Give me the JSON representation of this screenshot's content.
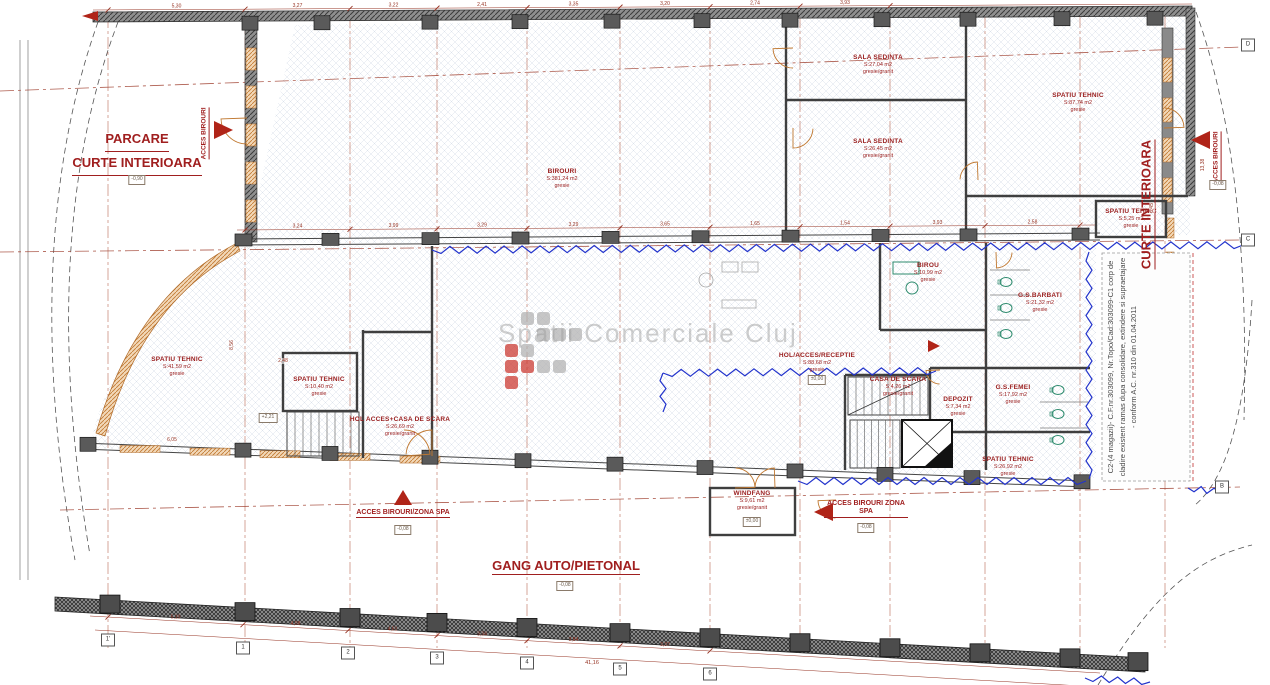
{
  "zones": {
    "parcare": {
      "line1": "PARCARE",
      "line2": "CURTE INTERIOARA"
    },
    "curte_right": "CURTE INTERIOARA",
    "gang": "GANG AUTO/PIETONAL"
  },
  "watermark": "Spatii Comerciale Cluj",
  "side_note": "C2-(4 magazii)- C.F.nr.303099, Nr.Topo/Cad:303099-C1 corp de cladire existent ramas dupa consolidare, extindere si supraetajare - conform A.C. nr.310 din 01.04.2011",
  "rooms": [
    {
      "name": "BIROURI",
      "area": "S:381,24 m2",
      "finish": "gresie"
    },
    {
      "name": "SALA SEDINTA",
      "area": "S:27,04 m2",
      "finish": "gresie/granit"
    },
    {
      "name": "SALA SEDINTA",
      "area": "S:26,45 m2",
      "finish": "gresie/granit"
    },
    {
      "name": "SPATIU TEHNIC",
      "area": "S:87,74 m2",
      "finish": "gresie"
    },
    {
      "name": "SPATIU TEHNIC",
      "area": "S:5,25 m2",
      "finish": "gresie"
    },
    {
      "name": "SPATIU TEHNIC",
      "area": "S:41,59 m2",
      "finish": "gresie"
    },
    {
      "name": "SPATIU TEHNIC",
      "area": "S:10,40 m2",
      "finish": "gresie"
    },
    {
      "name": "HOL ACCES+CASA DE SCARA",
      "area": "S:26,69 m2",
      "finish": "gresie/granit"
    },
    {
      "name": "HOL/ACCES/RECEPTIE",
      "area": "S:88,68 m2",
      "finish": "gresie"
    },
    {
      "name": "BIROU",
      "area": "S:10,99 m2",
      "finish": "gresie"
    },
    {
      "name": "G.S.BARBATI",
      "area": "S:21,32 m2",
      "finish": "gresie"
    },
    {
      "name": "G.S.FEMEI",
      "area": "S:17,92 m2",
      "finish": "gresie"
    },
    {
      "name": "CASA DE SCARA",
      "area": "S:4,26 m2",
      "finish": "gresie/granit"
    },
    {
      "name": "DEPOZIT",
      "area": "S:7,34 m2",
      "finish": "gresie"
    },
    {
      "name": "SPATIU TEHNIC",
      "area": "S:26,92 m2",
      "finish": "gresie"
    },
    {
      "name": "WINDFANG",
      "area": "S:9,61 m2",
      "finish": "gresie/granit"
    }
  ],
  "access_labels": [
    {
      "text": "ACCES BIROURI"
    },
    {
      "text": "ACCES BIROURI"
    },
    {
      "text": "ACCES BIROURI/ZONA SPA"
    },
    {
      "text": "ACCES BIROURI ZONA SPA"
    }
  ],
  "levels": [
    "±0,00",
    "-0,08",
    "-0,90",
    "±0,00",
    "+2,21",
    "-0,08",
    "-0,08",
    "-0,08"
  ],
  "grid": {
    "right": [
      "D",
      "C",
      "B"
    ],
    "bottom": [
      "1'",
      "1",
      "2",
      "3",
      "4",
      "5",
      "6"
    ]
  },
  "dims": {
    "top": [
      "5,30",
      "3,27",
      "3,22",
      "2,41",
      "3,35",
      "3,20",
      "2,74",
      "3,93"
    ],
    "mid": [
      "3,24",
      "3,99",
      "3,29",
      "3,29",
      "3,65",
      "1,65",
      "1,54",
      "3,93",
      "2,58"
    ],
    "bottom": [
      "5,10",
      "4,08",
      "4,51",
      "3,34",
      "3,84",
      "3,37"
    ],
    "bottom_total": "41,16",
    "left": [
      "6,05",
      "8,56",
      "2,48"
    ],
    "right": [
      "13,38",
      "6,45"
    ]
  },
  "colors": {
    "label_red": "#9b2020",
    "accent_red": "#b02418",
    "dim_red": "#963222",
    "grid_brown": "#b4604a",
    "blue_break": "#2233cc",
    "wall_gray": "#6e6e6e",
    "window_orange": "#c07830",
    "fixture_teal": "#2e8b6e"
  }
}
